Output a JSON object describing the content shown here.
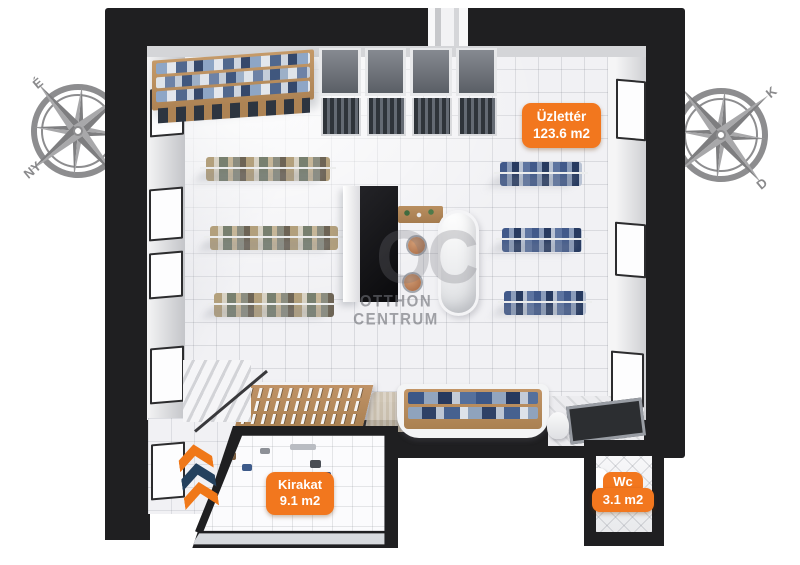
{
  "rooms": {
    "shop": {
      "name": "Üzlettér",
      "area": "123.6 m2"
    },
    "window_display": {
      "name": "Kirakat",
      "area": "9.1 m2"
    },
    "toilet": {
      "name": "Wc",
      "area": "3.1 m2"
    }
  },
  "compass_left": {
    "north": "É",
    "west": "NY"
  },
  "compass_right": {
    "east": "K",
    "south": "D"
  },
  "watermark": {
    "monogram": "OC",
    "name_line1": "OTTHON",
    "name_line2": "CENTRUM"
  },
  "colors": {
    "label_orange": "#f2771e",
    "wall_dark": "#1f1f21",
    "compass_gray": "#8d8d8f",
    "floor_light": "#f1f1f4",
    "wood": "#b48c5f",
    "denim_blue": "#3c5787",
    "chevron_navy": "#24415e"
  }
}
